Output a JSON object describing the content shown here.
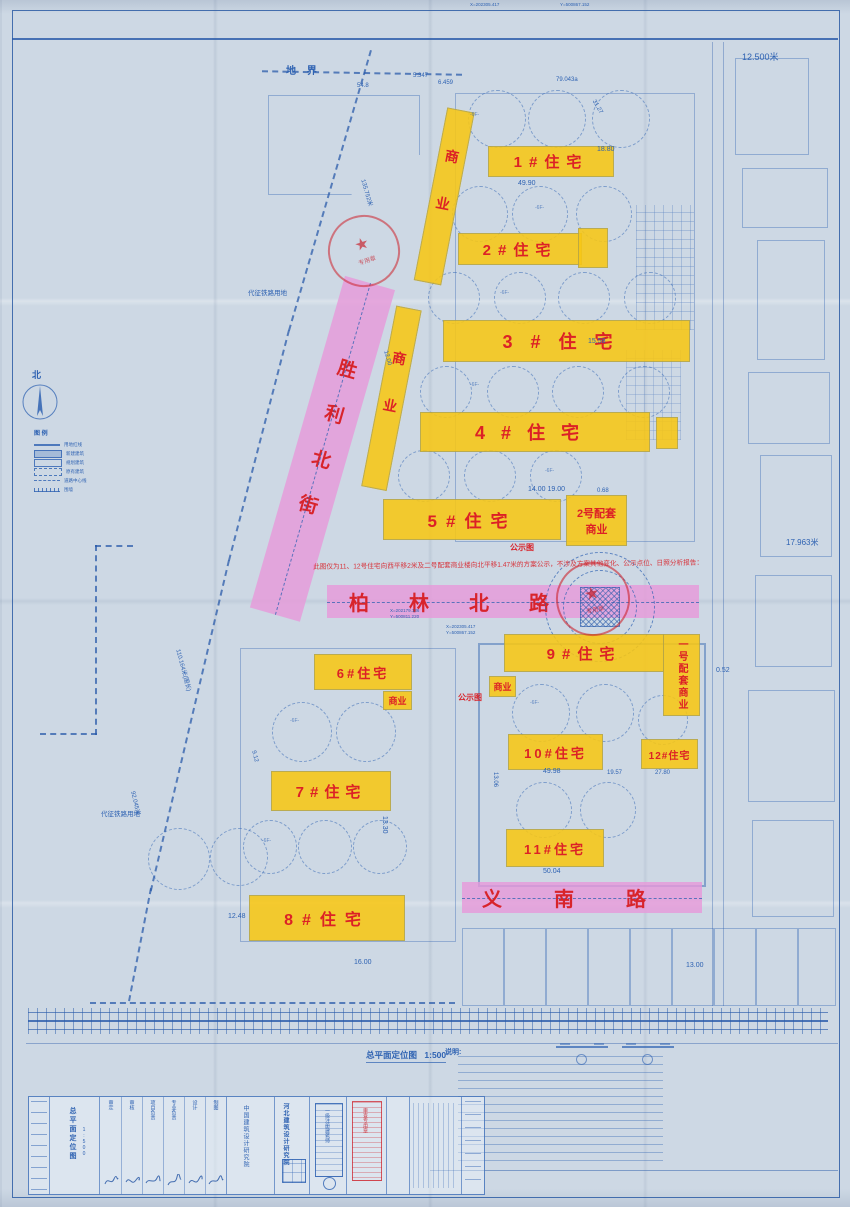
{
  "drawing": {
    "title": "总平面定位图",
    "scale": "1:500",
    "notes_header": "说明:"
  },
  "roads": {
    "shengli": "胜利北街",
    "bailin": "柏林北路",
    "yinan": "义南路"
  },
  "buildings": {
    "r1": "1#住宅",
    "r2": "2#住宅",
    "r3": "3#住宅",
    "r4": "4#住宅",
    "r5": "5#住宅",
    "r6": "6#住宅",
    "r7": "7#住宅",
    "r8": "8#住宅",
    "r9": "9#住宅",
    "r10": "10#住宅",
    "r11": "11#住宅",
    "r12": "12#住宅",
    "commercial_strip_north": "商业",
    "commercial_strip_mid": "商业",
    "commercial_small_6": "商业",
    "commercial_small_9": "商业",
    "peitao1": "一号配套商业",
    "peitao2_l1": "2号配套",
    "peitao2_l2": "商业"
  },
  "annotations": {
    "notice": "此图仅为11、12号住宅向西平移2米及二号配套商业楼向北平移1.47米的方案公示，不涉及方案其他变化、公示点位、日照分析报告：",
    "gongshitu_1": "公示图",
    "gongshitu_2": "公示图",
    "dijie": "地 界",
    "north_char": "北",
    "railway_land_1": "代征铁路用地",
    "railway_land_2": "代征铁路用地",
    "seal_text": "专用章",
    "seal_star": "★",
    "floor_tag": "-6F-"
  },
  "dimensions": {
    "top_right": "12.500米",
    "right_mid": "17.963米",
    "top_width": "79.043a",
    "left_len": "135.752米",
    "left_perimeter": "110.164米(围长)",
    "left_len2": "92.045米",
    "b1_w": "49.90",
    "b1_d": "18.80",
    "b3_d": "15.58",
    "b5_gap": "14.00 19.00",
    "b5_off": "0.68",
    "b9_off": "0.52",
    "b10_w": "49.98",
    "gap_10_12": "19.57",
    "w_12": "27.80",
    "b11_w": "50.04",
    "l7": "13.30",
    "l8": "12.48",
    "l9": "9.12",
    "l10": "13.06",
    "bottom_1": "16.00",
    "bottom_2": "13.00",
    "misc_1": "5.347",
    "misc_2": "6.459",
    "misc_3": "31.27",
    "misc_4": "54.8",
    "misc_5": "12.00",
    "coord_1": "X=202179.136",
    "coord_2": "Y=500811.220",
    "coord_3": "X=202305.417",
    "coord_4": "Y=500867.152"
  },
  "legend": {
    "title": "图 例",
    "items": [
      {
        "label": "用地红线"
      },
      {
        "label": "新建建筑"
      },
      {
        "label": "规划建筑"
      },
      {
        "label": "原有建筑"
      },
      {
        "label": "道路中心线"
      },
      {
        "label": "围墙"
      }
    ]
  },
  "titleblock": {
    "institute": "河北建筑设计研究院",
    "partner": "中国建筑设计研究院",
    "cert_text": "一级注册建筑师",
    "red_stamp_text": "审查专用章",
    "sig_labels": [
      "审定",
      "审核",
      "项目负责",
      "专业负责",
      "设计",
      "制图"
    ]
  }
}
